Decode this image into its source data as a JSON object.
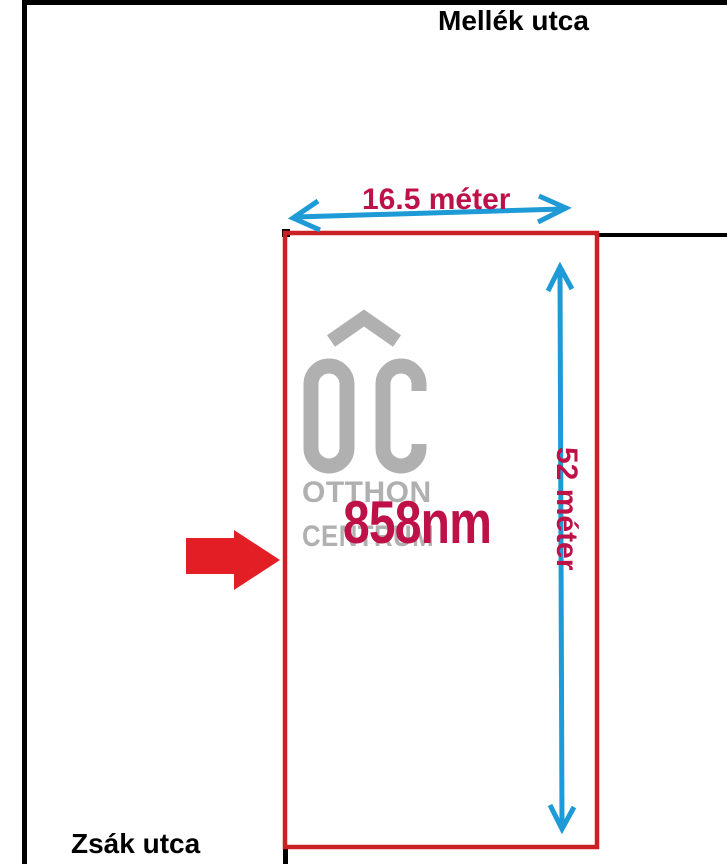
{
  "diagram": {
    "streets": {
      "top": "Mellék utca",
      "bottom": "Zsák utca"
    },
    "plot": {
      "width_label": "16.5 méter",
      "depth_label": "52 méter",
      "area_label": "858nm"
    },
    "watermark": {
      "monogram": "OC",
      "line1": "OTTHON",
      "line2": "CENTRUM"
    },
    "colors": {
      "boundary_black": "#000000",
      "plot_border_red": "#cb2026",
      "pointer_red": "#e41e25",
      "dimension_arrow_blue": "#1e9ad6",
      "label_crimson": "#be1147",
      "watermark_gray": "#b0b0b0"
    }
  }
}
